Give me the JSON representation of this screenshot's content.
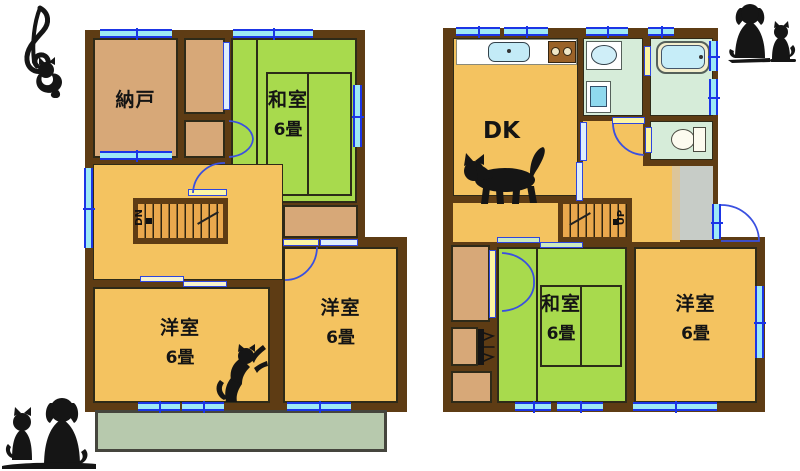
{
  "colors": {
    "wall": "#5e3c14",
    "room_wood_orange": "#f4c360",
    "room_tatami_green": "#a8da4d",
    "room_storage_tan": "#d7a878",
    "sanitary_green": "#d6ecd9",
    "balcony_sage": "#b7c9ad",
    "entrance_gray": "#c7ccc7",
    "window_fill": "#9ee9f6",
    "window_line": "#1b35e6",
    "door_fill": "#fbf4a4",
    "door_line": "#2e46df",
    "silhouette": "#151515"
  },
  "floor2": {
    "nando": {
      "label": "納戸"
    },
    "washitsu": {
      "label": "和室",
      "size": "6畳"
    },
    "youshitsu_left": {
      "label": "洋室",
      "size": "6畳"
    },
    "youshitsu_right": {
      "label": "洋室",
      "size": "6畳"
    },
    "stairs": {
      "label": "DN"
    }
  },
  "floor1": {
    "dk": {
      "label": "DK"
    },
    "washitsu": {
      "label": "和室",
      "size": "6畳"
    },
    "youshitsu": {
      "label": "洋室",
      "size": "6畳"
    },
    "stairs": {
      "label": "UP"
    }
  },
  "icons": {
    "treble_clef_cat": "treble-clef-with-hanging-cat",
    "dog_cat_pair_top_right": "sitting-dog-and-cat-silhouette",
    "walking_cat": "walking-cat-silhouette",
    "reaching_cat": "standing-reaching-cat-silhouette",
    "cat_dog_pair_bottom_left": "sitting-cat-and-dog-silhouette",
    "kitchen_sink": "kitchen-sink",
    "stove": "gas-stove",
    "wash_basin": "wash-basin",
    "washing_machine": "washing-machine",
    "bathtub": "bathtub",
    "toilet": "toilet"
  }
}
